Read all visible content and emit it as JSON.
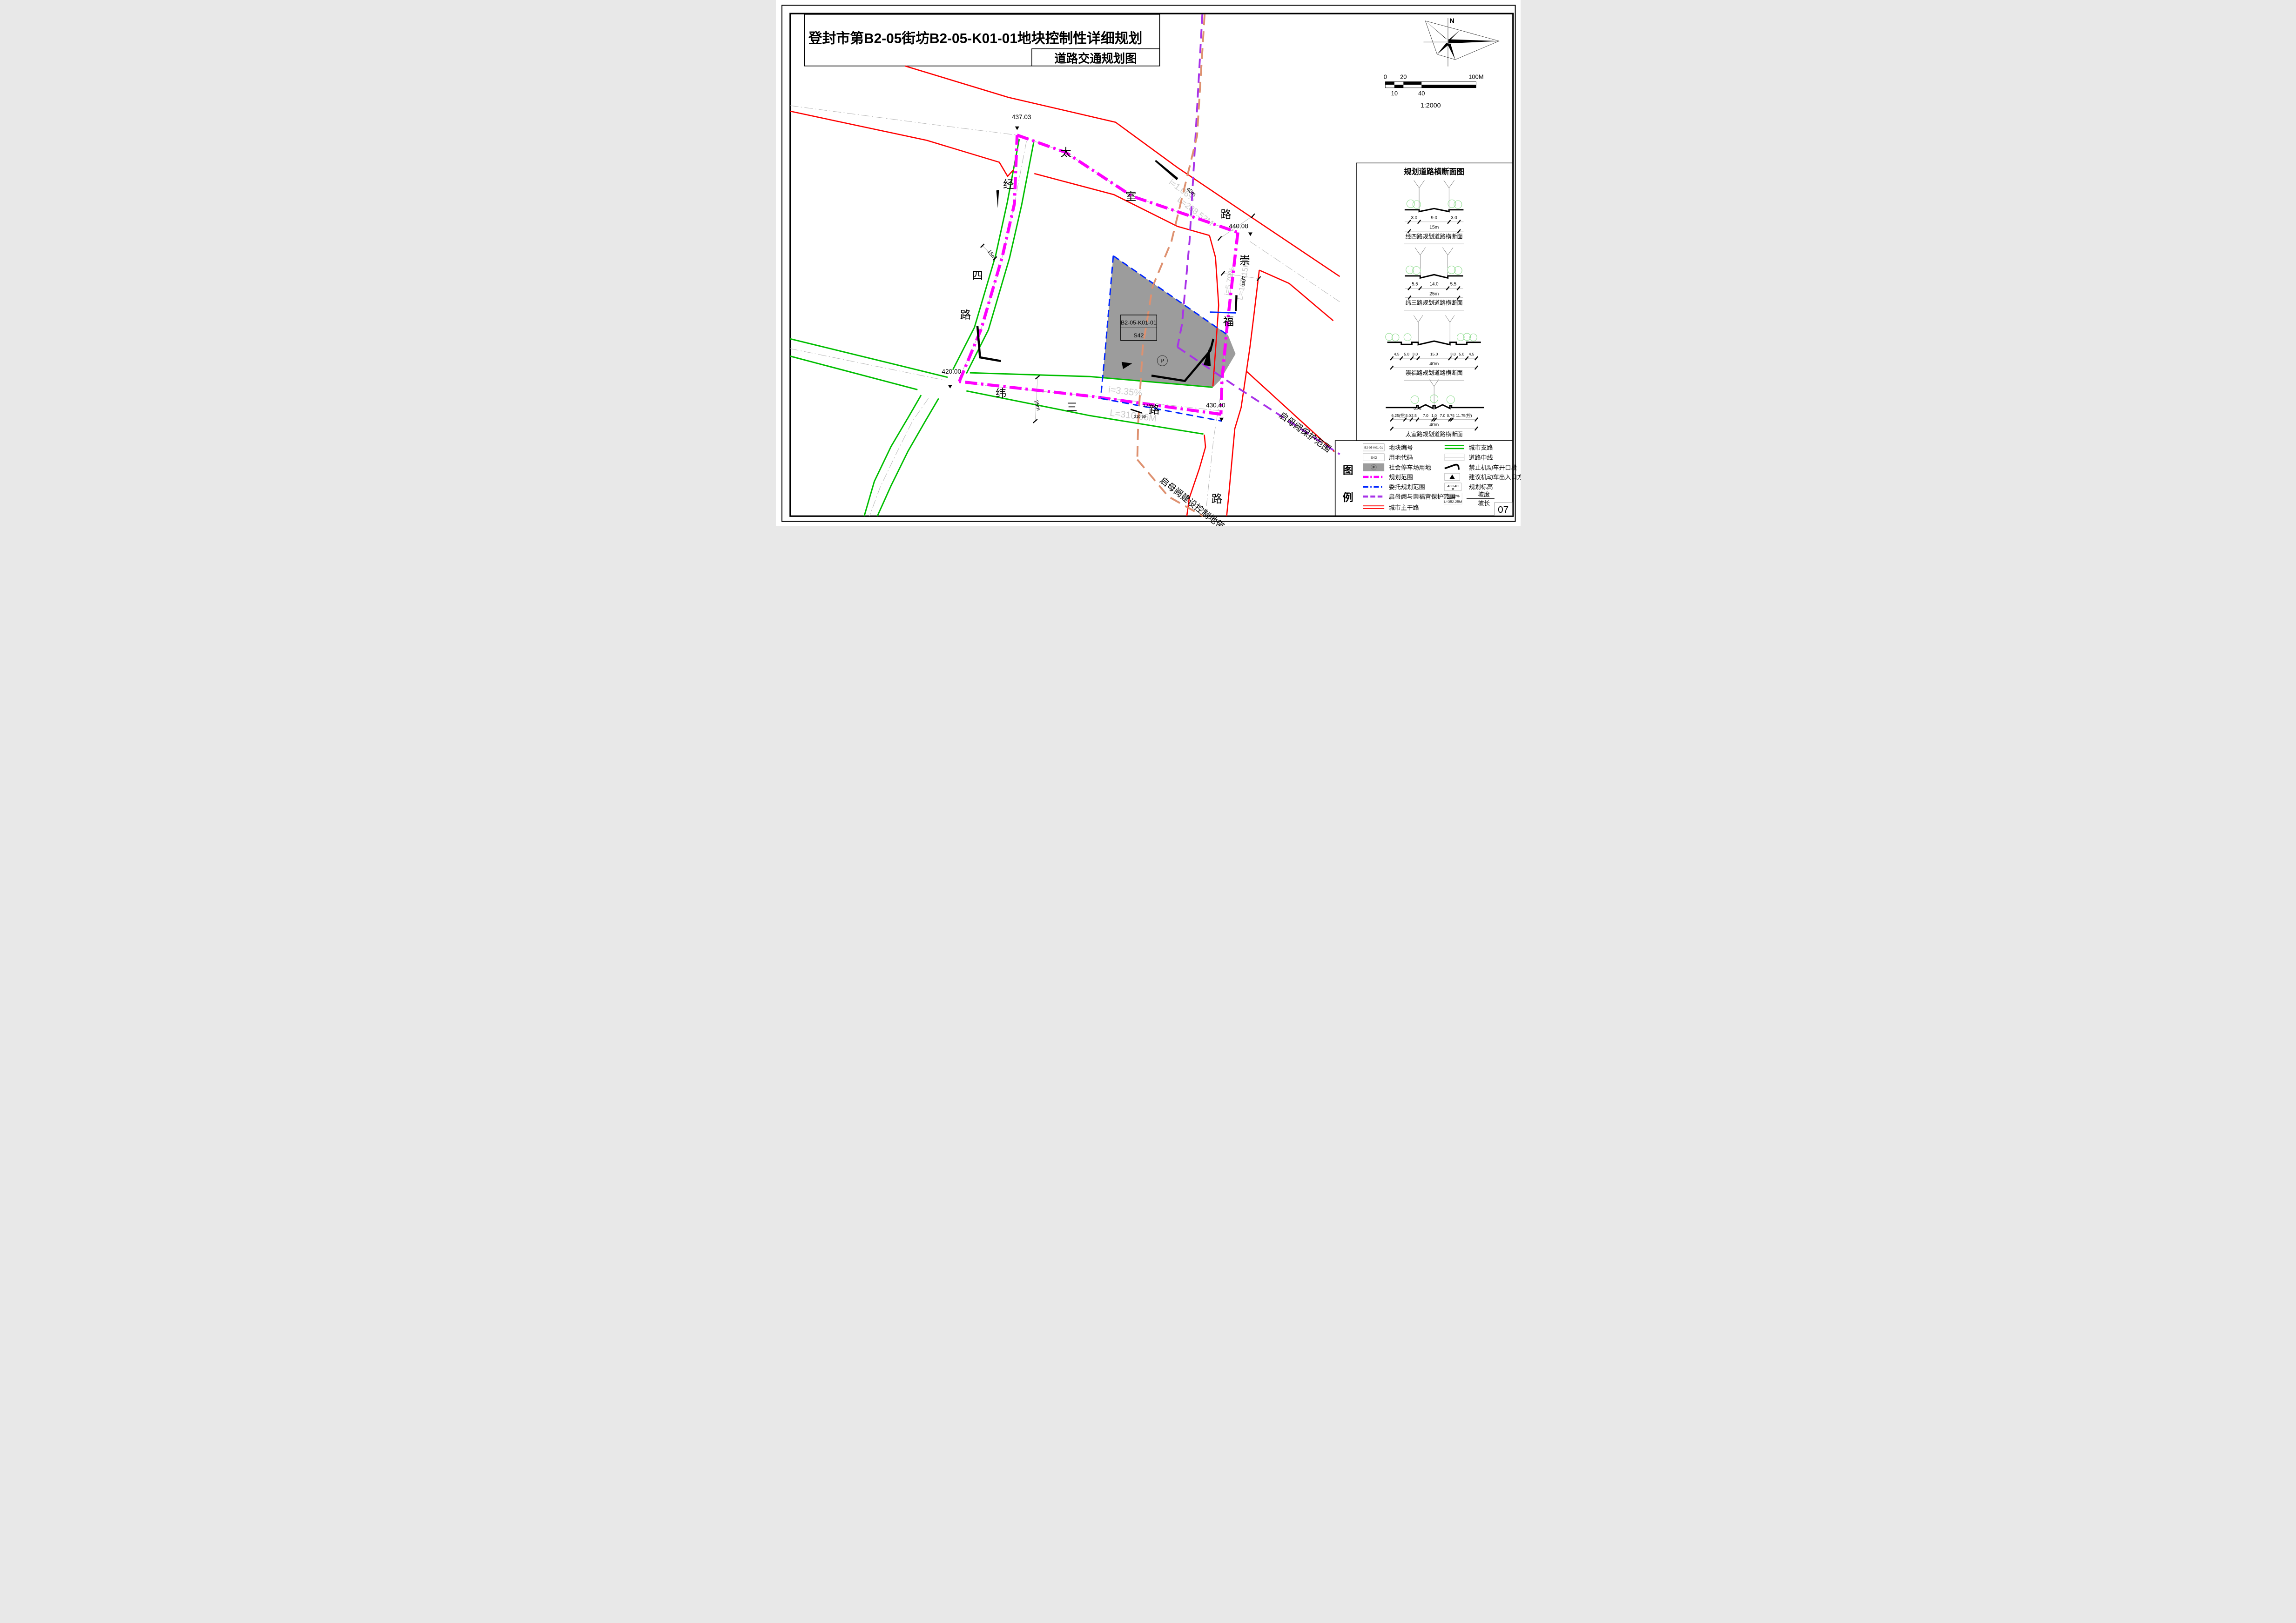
{
  "page": {
    "number": "07"
  },
  "title": {
    "line1": "登封市第B2-05街坊B2-05-K01-01地块控制性详细规划",
    "line2": "道路交通规划图"
  },
  "compass": {
    "label": "N"
  },
  "scalebar": {
    "t0": "0",
    "t20": "20",
    "t100": "100M",
    "b10": "10",
    "b40": "40",
    "ratio": "1:2000"
  },
  "map": {
    "roads": {
      "taishi": {
        "c1": "太",
        "c2": "室",
        "c3": "路",
        "width": "40m"
      },
      "jingsi": {
        "c1": "经",
        "c2": "四",
        "c3": "路",
        "width": "15m"
      },
      "weisan": {
        "c1": "纬",
        "c2": "三",
        "c3": "路",
        "width": "25m"
      },
      "chongfu": {
        "c1": "崇",
        "c2": "福",
        "c3": "路",
        "width": "40m"
      }
    },
    "elevations": {
      "nw": "437.03",
      "ne": "440.08",
      "se": "430.40",
      "sw": "420.00"
    },
    "slopes": {
      "taishi": {
        "grade": "i=1.06%",
        "length": "L=288.52M"
      },
      "weisan": {
        "grade": "i=3.35%",
        "length": "L=310.66M"
      },
      "weisan_small": {
        "grade": "3.35%",
        "length": "310.60"
      },
      "chongfu": {
        "grade": "i=5.79%",
        "length": "L=167.15M"
      }
    },
    "plot": {
      "code": "B2-05-K01-01",
      "use_code": "S42",
      "parking": "P"
    },
    "protection": {
      "scope": "启母阙保护范围",
      "control": "启母阙建设控制地带"
    }
  },
  "cross_sections": {
    "title": "规划道路横断面图",
    "s1": {
      "p0": "3.0",
      "p1": "9.0",
      "p2": "3.0",
      "total": "15m",
      "caption": "经四路规划道路横断面"
    },
    "s2": {
      "p0": "5.5",
      "p1": "14.0",
      "p2": "5.5",
      "total": "25m",
      "caption": "纬三路规划道路横断面"
    },
    "s3": {
      "p0": "4.5",
      "p1": "5.0",
      "p2": "3.0",
      "p3": "15.0",
      "p4": "3.0",
      "p5": "5.0",
      "p6": "4.5",
      "total": "40m",
      "caption": "崇福路规划道路横断面"
    },
    "s4": {
      "p0": "6.25(控)",
      "p1": "3.0",
      "p2": "2.5",
      "p3": "0.75",
      "p4": "7.0",
      "p5": "1.0",
      "p6": "7.0",
      "p7": "0.75",
      "p8": "11.75(控)",
      "total": "40m",
      "caption": "太室路规划道路横断面"
    }
  },
  "legend": {
    "h1": "图",
    "h2": "例",
    "plot_code": {
      "sym": "B2-05-K01-01",
      "label": "地块编号"
    },
    "use_code": {
      "sym": "S42",
      "label": "用地代码"
    },
    "parking": {
      "sym": "P",
      "label": "社会停车场用地"
    },
    "scope": {
      "label": "规划范围"
    },
    "entrust": {
      "label": "委托规划范围"
    },
    "protect": {
      "label": "启母阙与崇福宫保护范围"
    },
    "main_road": {
      "label": "城市主干路"
    },
    "branch_road": {
      "label": "城市支路"
    },
    "centerline": {
      "label": "道路中线"
    },
    "no_open": {
      "label": "禁止机动车开口段"
    },
    "entrance": {
      "label": "建议机动车出入口方向"
    },
    "elevation": {
      "sym": "430.40",
      "label": "规划标高"
    },
    "slope": {
      "sym_grade": "i=1.08%",
      "sym_len": "L=352.25M",
      "num": "坡度",
      "den": "坡长"
    }
  },
  "colors": {
    "main_road": "#ff0000",
    "branch_road": "#00be00",
    "scope": "#ff00ff",
    "entrust": "#0026ff",
    "protect": "#a832e8",
    "control_zone": "#de9170",
    "parking_fill": "#9c9c9c"
  }
}
